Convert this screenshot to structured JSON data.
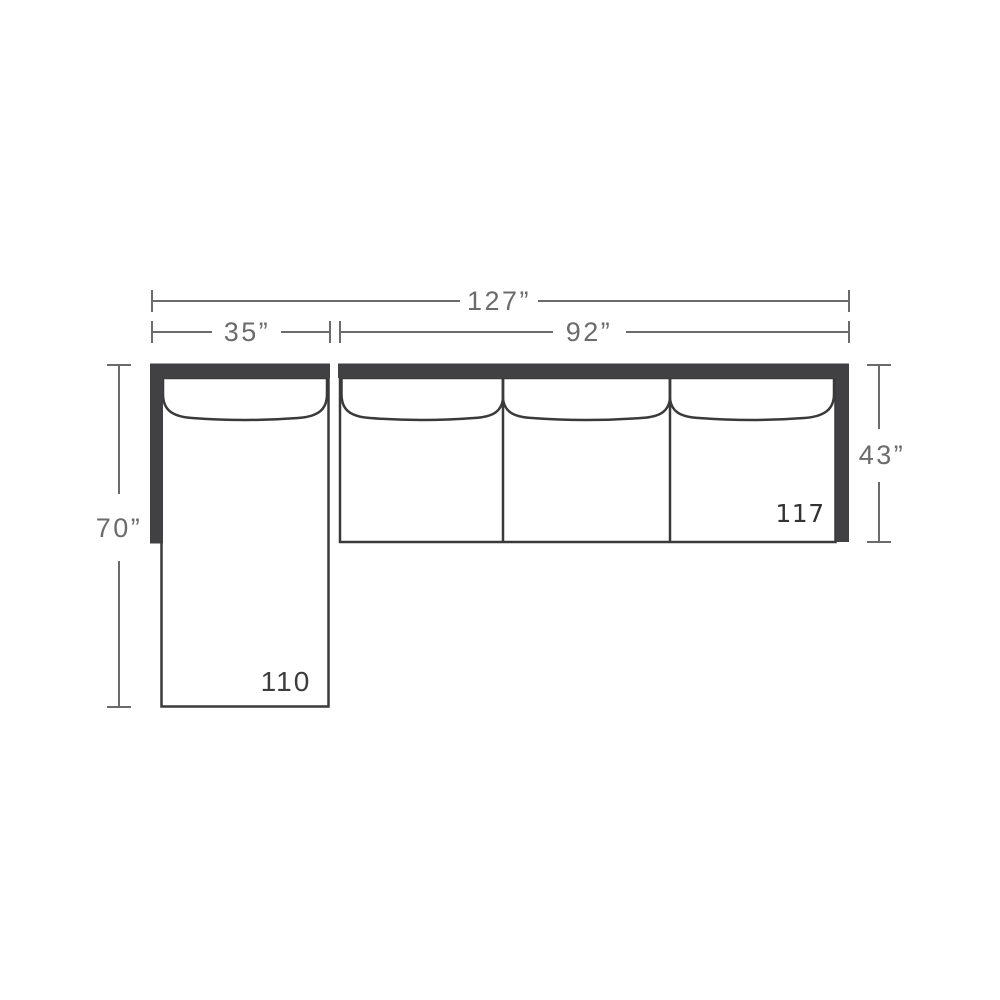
{
  "colors": {
    "background": "#ffffff",
    "frame_dark": "#414042",
    "outline": "#3a3a3a",
    "dimension_gray": "#6b6b6b"
  },
  "dimensions": {
    "total_width": "127”",
    "chaise_width": "35”",
    "sofa_width": "92”",
    "chaise_depth": "70”",
    "sofa_depth": "43”"
  },
  "labels": {
    "chaise_piece": "110",
    "sofa_piece": "117"
  }
}
